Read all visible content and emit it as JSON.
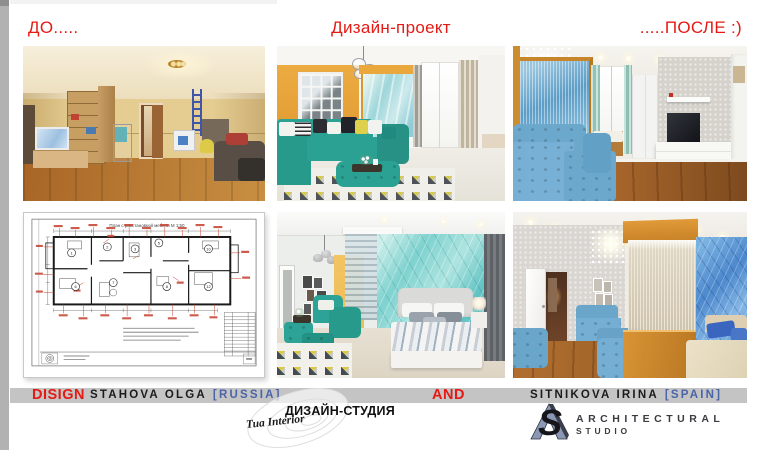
{
  "header": {
    "before": "ДО.....",
    "project": "Дизайн-проект",
    "after": ".....ПОСЛЕ :)"
  },
  "floor_plan": {
    "title": "План с расстановкой мебели М 1:50",
    "rooms": [
      "1",
      "2",
      "3",
      "5",
      "6",
      "7",
      "8",
      "10",
      "12"
    ]
  },
  "footer": {
    "design_word": "DISIGN",
    "designer1_name": "STAHOVA OLGA",
    "designer1_country": "[RUSSIA]",
    "and_word": "AND",
    "designer2_name": "SITNIKOVA IRINA",
    "designer2_country": "[SPAIN]"
  },
  "studio": {
    "title": "ДИЗАЙН-СТУДИЯ",
    "script": "Tua Interior"
  },
  "aslogo": {
    "s_letter": "S",
    "line1": "ARCHITECTURAL",
    "line2": "STUDIO"
  },
  "colors": {
    "accent_red": "#e51a14",
    "country_blue": "#4a64a8",
    "bar_gray": "#c4c4c4",
    "teal": "#2aa092",
    "orange": "#e9a83e"
  }
}
